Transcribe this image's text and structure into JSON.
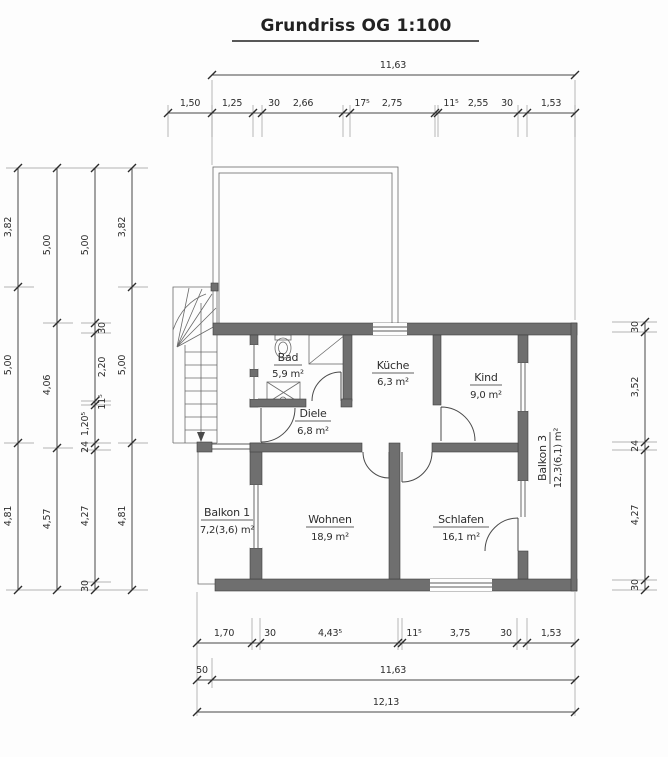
{
  "title": "Grundriss OG 1:100",
  "colors": {
    "wall": "#6f6f6f",
    "line": "#4a4a4a",
    "text": "#2d2d2d"
  },
  "rooms": {
    "bad": {
      "name": "Bad",
      "area": "5,9 m²"
    },
    "kueche": {
      "name": "Küche",
      "area": "6,3 m²"
    },
    "kind": {
      "name": "Kind",
      "area": "9,0 m²"
    },
    "diele": {
      "name": "Diele",
      "area": "6,8 m²"
    },
    "balkon1": {
      "name": "Balkon 1",
      "area": "7,2(3,6) m²"
    },
    "wohnen": {
      "name": "Wohnen",
      "area": "18,9 m²"
    },
    "schlafen": {
      "name": "Schlafen",
      "area": "16,1 m²"
    },
    "balkon3": {
      "name": "Balkon 3",
      "area": "12,3(6,1) m²"
    }
  },
  "dims": {
    "top_total": "11,63",
    "top_row": [
      "1,50",
      "1,25",
      "30",
      "2,66",
      "17⁵",
      "2,75",
      "11⁵",
      "2,55",
      "30",
      "1,53"
    ],
    "left_col1": [
      "3,82",
      "5,00",
      "4,81"
    ],
    "left_col2": [
      "5,00",
      "4,06",
      "4,57"
    ],
    "left_col3": [
      "5,00",
      "30",
      "2,20",
      "11⁵",
      "1,20⁵",
      "24",
      "4,27",
      "30"
    ],
    "left_col4": [
      "3,82",
      "5,00",
      "4,81"
    ],
    "right_col": [
      "30",
      "3,52",
      "24",
      "4,27",
      "30"
    ],
    "bottom_row1": [
      "1,70",
      "30",
      "4,43⁵",
      "11⁵",
      "3,75",
      "30",
      "1,53"
    ],
    "bottom_row2": [
      "50",
      "11,63"
    ],
    "bottom_total": "12,13"
  }
}
